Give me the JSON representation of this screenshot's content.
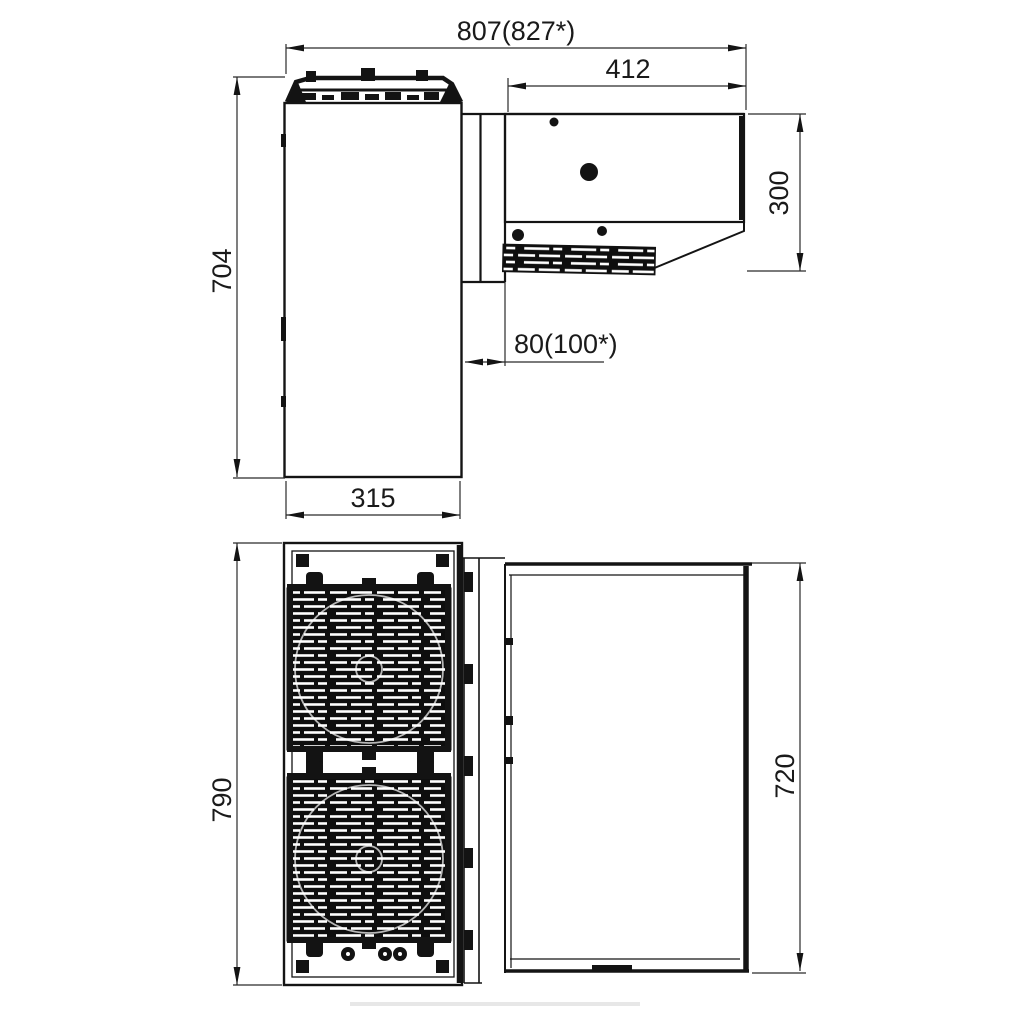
{
  "page": {
    "background": "#ffffff",
    "line_color": "#141414"
  },
  "dimensions": {
    "d807": "807(827*)",
    "d412": "412",
    "d300": "300",
    "d704": "704",
    "d80": "80(100*)",
    "d315": "315",
    "d790": "790",
    "d720": "720"
  }
}
